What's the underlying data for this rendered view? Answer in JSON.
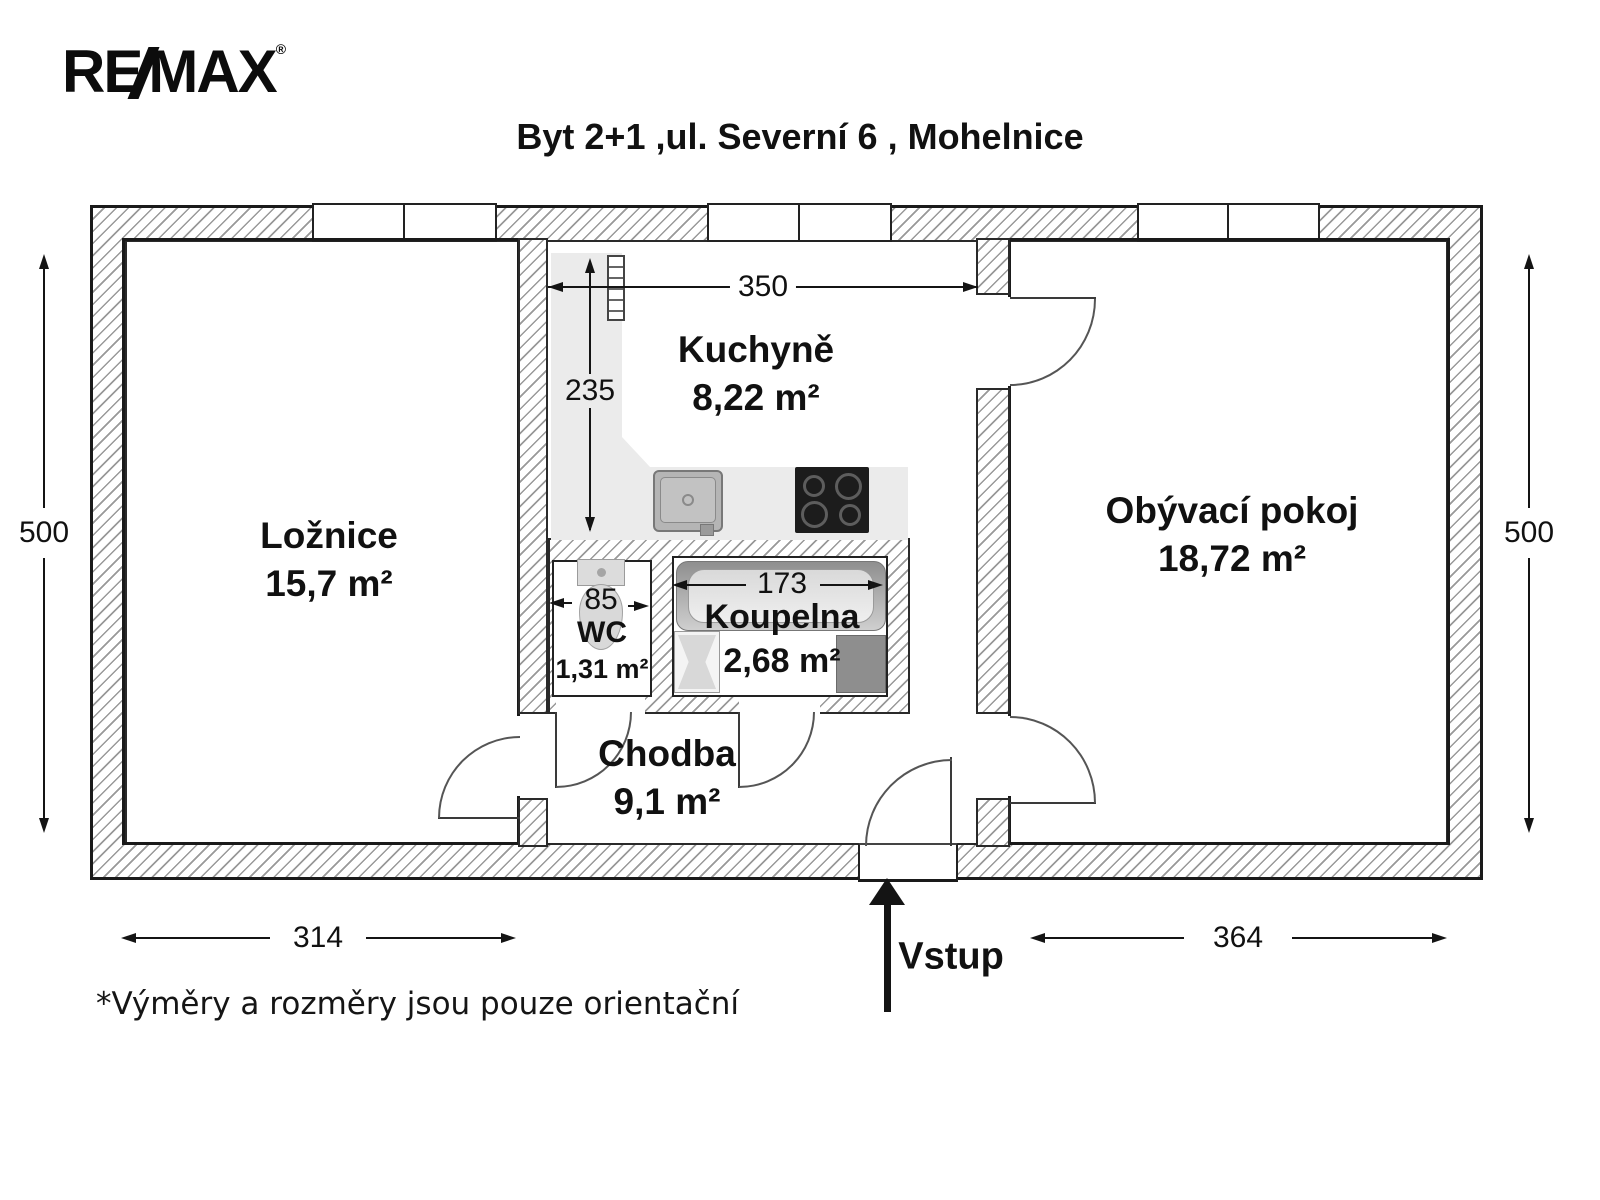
{
  "logo": {
    "part1": "RE",
    "part2": "MAX",
    "registered": "®"
  },
  "title": "Byt 2+1 ,ul. Severní 6 , Mohelnice",
  "footer_note": "*Výměry a rozměry jsou pouze orientační",
  "entrance": {
    "label": "Vstup"
  },
  "rooms": [
    {
      "id": "loznice",
      "name": "Ložnice",
      "area": "15,7 m²"
    },
    {
      "id": "kuchyne",
      "name": "Kuchyně",
      "area": "8,22 m²"
    },
    {
      "id": "wc",
      "name": "WC",
      "area": "1,31 m²"
    },
    {
      "id": "koupelna",
      "name": "Koupelna",
      "area": "2,68 m²"
    },
    {
      "id": "chodba",
      "name": "Chodba",
      "area": "9,1 m²"
    },
    {
      "id": "obyvaci",
      "name": "Obývací pokoj",
      "area": "18,72 m²"
    }
  ],
  "dimensions": {
    "kitchen_width": {
      "value": "350",
      "orientation": "horizontal"
    },
    "kitchen_height": {
      "value": "235",
      "orientation": "vertical"
    },
    "wc_width": {
      "value": "85",
      "orientation": "horizontal"
    },
    "bath_width": {
      "value": "173",
      "orientation": "horizontal"
    },
    "left_height": {
      "value": "500",
      "orientation": "vertical"
    },
    "right_height": {
      "value": "500",
      "orientation": "vertical"
    },
    "bottom_left": {
      "value": "314",
      "orientation": "horizontal"
    },
    "bottom_right": {
      "value": "364",
      "orientation": "horizontal"
    }
  },
  "colors": {
    "wall_hatch": "#999999",
    "counter": "#ebebeb",
    "cooktop": "#1c1c1c",
    "appliance": "#8e8e8e",
    "ink": "#111111"
  }
}
